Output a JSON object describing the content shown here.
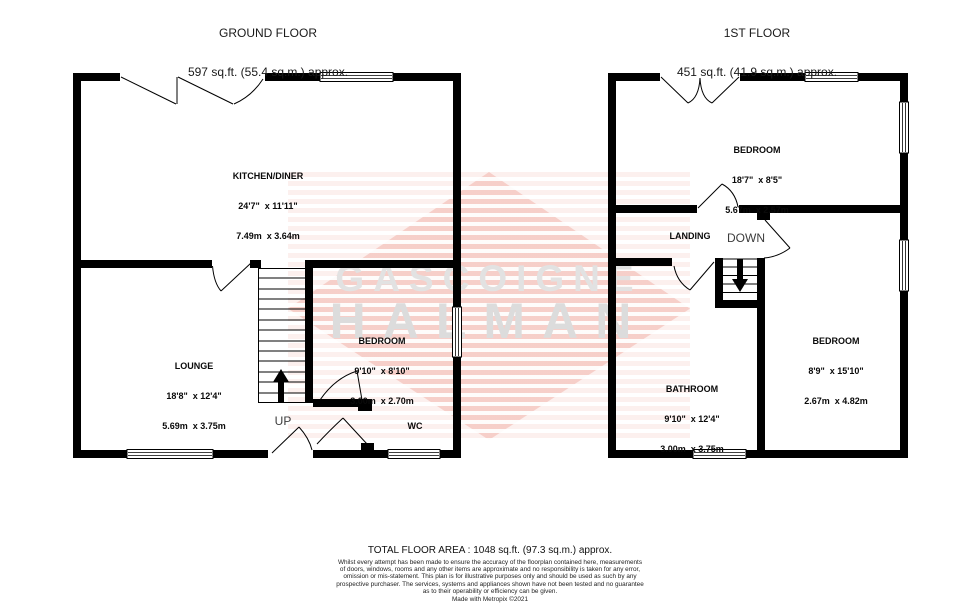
{
  "ground_floor": {
    "title": "GROUND FLOOR",
    "area": "597 sq.ft. (55.4 sq.m.) approx.",
    "rooms": [
      {
        "name": "KITCHEN/DINER",
        "imperial": "24'7\"  x 11'11\"",
        "metric": "7.49m  x 3.64m"
      },
      {
        "name": "LOUNGE",
        "imperial": "18'8\"  x 12'4\"",
        "metric": "5.69m  x 3.75m"
      },
      {
        "name": "BEDROOM",
        "imperial": "9'10\"  x 8'10\"",
        "metric": "3.00m  x 2.70m"
      },
      {
        "name": "WC",
        "imperial": "",
        "metric": ""
      }
    ],
    "stair_label": "UP"
  },
  "first_floor": {
    "title": "1ST FLOOR",
    "area": "451 sq.ft. (41.9 sq.m.) approx.",
    "rooms": [
      {
        "name": "BEDROOM",
        "imperial": "18'7\"  x 8'5\"",
        "metric": "5.67m  x 2.57m"
      },
      {
        "name": "BEDROOM",
        "imperial": "8'9\"  x 15'10\"",
        "metric": "2.67m  x 4.82m"
      },
      {
        "name": "BATHROOM",
        "imperial": "9'10\"  x 12'4\"",
        "metric": "3.00m  x 3.75m"
      },
      {
        "name": "LANDING",
        "imperial": "",
        "metric": ""
      }
    ],
    "stair_label": "DOWN"
  },
  "watermark": {
    "line1": "GASCOIGNE",
    "line2": "HALMAN",
    "stripe_color": "#e25c48",
    "text_color": "#dedede"
  },
  "footer": {
    "total_area": "TOTAL FLOOR AREA : 1048 sq.ft. (97.3 sq.m.) approx.",
    "disclaimer_lines": [
      "Whilst every attempt has been made to ensure the accuracy of the floorplan contained here, measurements",
      "of doors, windows, rooms and any other items are approximate and no responsibility is taken for any error,",
      "omission or mis-statement. This plan is for illustrative purposes only and should be used as such by any",
      "prospective purchaser. The services, systems and appliances shown have not been tested and no guarantee",
      "as to their operability or efficiency can be given."
    ],
    "credit": "Made with Metropix ©2021"
  }
}
